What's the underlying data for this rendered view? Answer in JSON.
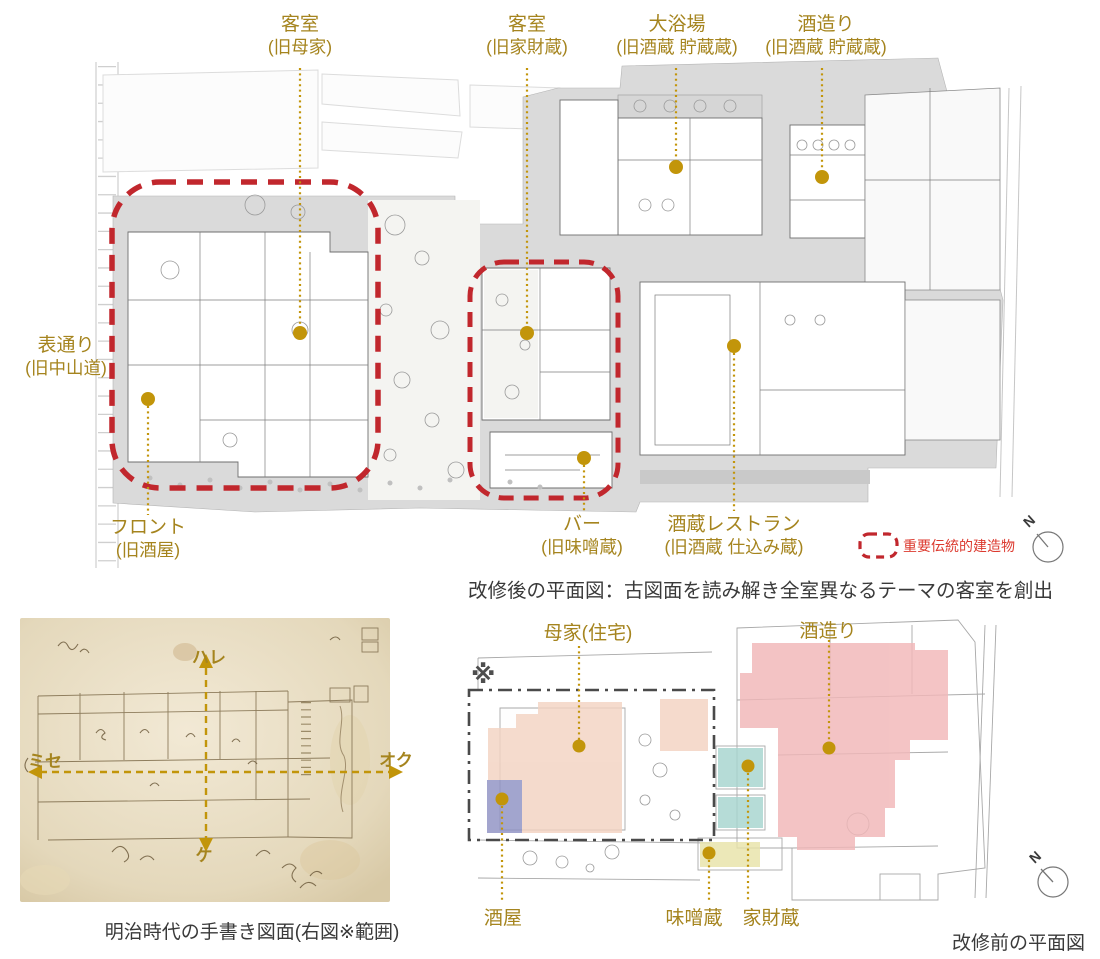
{
  "after_plan": {
    "caption": "改修後の平面図：古図面を読み解き全室異なるテーマの客室を創出",
    "legend_label": "重要伝統的建造物",
    "compass_n": "N",
    "labels": {
      "guest_room_omoya": {
        "line1": "客室",
        "line2": "(旧母家)"
      },
      "guest_room_kazaigura": {
        "line1": "客室",
        "line2": "(旧家財蔵)"
      },
      "daiyokujo": {
        "line1": "大浴場",
        "line2": "(旧酒蔵 貯蔵蔵)"
      },
      "sakazukuri": {
        "line1": "酒造り",
        "line2": "(旧酒蔵 貯蔵蔵)"
      },
      "omotedori": {
        "line1": "表通り",
        "line2": "(旧中山道)"
      },
      "front_desk": {
        "line1": "フロント",
        "line2": "(旧酒屋)"
      },
      "bar": {
        "line1": "バー",
        "line2": "(旧味噌蔵)"
      },
      "restaurant": {
        "line1": "酒蔵レストラン",
        "line2": "(旧酒蔵 仕込み蔵)"
      }
    }
  },
  "old_map": {
    "caption": "明治時代の手書き図面(右図※範囲)",
    "axes": {
      "top": "ハレ",
      "bottom": "ケ",
      "left": "ミセ",
      "right": "オク"
    }
  },
  "before_plan": {
    "caption": "改修前の平面図",
    "range_marker": "※",
    "compass_n": "N",
    "labels": {
      "omoya": "母家(住宅)",
      "sakazukuri": "酒造り",
      "sakaya": "酒屋",
      "misogura": "味噌蔵",
      "kazaigura": "家財蔵"
    }
  },
  "colors": {
    "label_gold": "#a5841e",
    "leader_gold": "#c2950a",
    "heritage_red": "#c1272d",
    "legend_red": "#dc3a2f",
    "caption_gray": "#3a3a3a",
    "overlay_pink": "#f3d3c2",
    "overlay_red": "#f1b7b8",
    "overlay_purple": "#8f92c4",
    "overlay_teal": "#a7d5cf",
    "overlay_yellow": "#e9e4a9"
  }
}
